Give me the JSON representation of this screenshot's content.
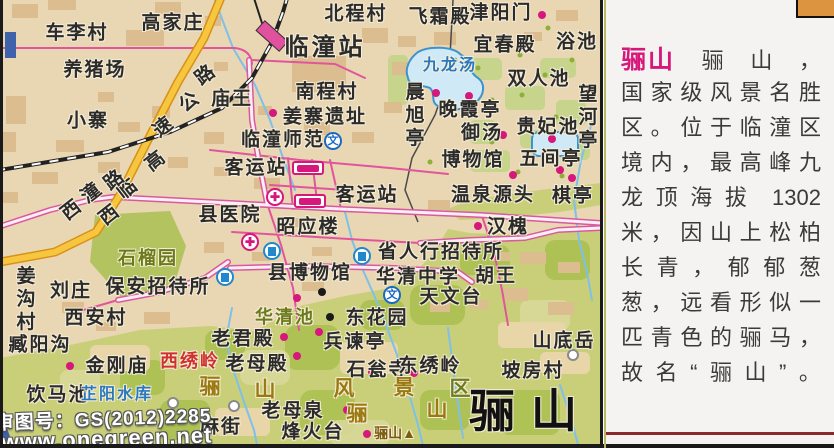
{
  "colors": {
    "accent_magenta": "#d6177b",
    "road_pink": "#e0559c",
    "highway_yellow": "#f6c73e",
    "stream_blue": "#7fc0e8",
    "lake_fill": "#cfe9f7",
    "lake_stroke": "#3d93cc",
    "town_bg": "#e9d6b2",
    "mountain_green": "#c9cf78",
    "panel_bg": "#f4f3f1",
    "orange_tab": "#dd9440",
    "red_label": "#d03030",
    "olive_label": "#6b7a1a"
  },
  "map": {
    "watermark": {
      "line1": "审图号：GS(2012)2285",
      "line2": "www.onegreen.net"
    },
    "labels": [
      {
        "t": "车李村",
        "x": 77,
        "y": 33
      },
      {
        "t": "高家庄",
        "x": 173,
        "y": 23
      },
      {
        "t": "北程村",
        "x": 356,
        "y": 14
      },
      {
        "t": "临潼站",
        "x": 325,
        "y": 48,
        "c": "lg"
      },
      {
        "t": "飞霜殿",
        "x": 440,
        "y": 17
      },
      {
        "t": "津阳门",
        "x": 501,
        "y": 13
      },
      {
        "t": "宜春殿",
        "x": 505,
        "y": 45
      },
      {
        "t": "浴池",
        "x": 577,
        "y": 42
      },
      {
        "t": "养猪场",
        "x": 95,
        "y": 70
      },
      {
        "t": "庙王",
        "x": 232,
        "y": 99
      },
      {
        "t": "南程村",
        "x": 327,
        "y": 92
      },
      {
        "t": "双人池",
        "x": 539,
        "y": 79
      },
      {
        "t": "小寨",
        "x": 88,
        "y": 121
      },
      {
        "t": "姜寨遗址",
        "x": 325,
        "y": 117
      },
      {
        "t": "临潼师范",
        "x": 283,
        "y": 140
      },
      {
        "t": "晚霞亭",
        "x": 470,
        "y": 110
      },
      {
        "t": "贵妃池",
        "x": 548,
        "y": 127
      },
      {
        "t": "御汤",
        "x": 482,
        "y": 133
      },
      {
        "t": "博物馆",
        "x": 473,
        "y": 160
      },
      {
        "t": "五间亭",
        "x": 551,
        "y": 159
      },
      {
        "t": "客运站",
        "x": 256,
        "y": 168
      },
      {
        "t": "客运站",
        "x": 367,
        "y": 195
      },
      {
        "t": "温泉源头",
        "x": 493,
        "y": 195
      },
      {
        "t": "棋亭",
        "x": 573,
        "y": 196
      },
      {
        "t": "县医院",
        "x": 230,
        "y": 215
      },
      {
        "t": "昭应楼",
        "x": 308,
        "y": 227
      },
      {
        "t": "汉槐",
        "x": 508,
        "y": 227
      },
      {
        "t": "省人行招待所",
        "x": 441,
        "y": 252
      },
      {
        "t": "县博物馆",
        "x": 310,
        "y": 273
      },
      {
        "t": "华清中学",
        "x": 418,
        "y": 277
      },
      {
        "t": "胡王",
        "x": 496,
        "y": 276
      },
      {
        "t": "天文台",
        "x": 451,
        "y": 297
      },
      {
        "t": "刘庄",
        "x": 71,
        "y": 291
      },
      {
        "t": "保安招待所",
        "x": 158,
        "y": 287
      },
      {
        "t": "西安村",
        "x": 96,
        "y": 318
      },
      {
        "t": "臧阳沟",
        "x": 40,
        "y": 345
      },
      {
        "t": "金刚庙",
        "x": 117,
        "y": 366
      },
      {
        "t": "饮马池",
        "x": 58,
        "y": 395
      },
      {
        "t": "老君殿",
        "x": 243,
        "y": 339
      },
      {
        "t": "兵谏亭",
        "x": 355,
        "y": 342
      },
      {
        "t": "老母殿",
        "x": 257,
        "y": 364
      },
      {
        "t": "石瓮寺",
        "x": 378,
        "y": 370
      },
      {
        "t": "东绣岭",
        "x": 430,
        "y": 366
      },
      {
        "t": "山底岳",
        "x": 564,
        "y": 341
      },
      {
        "t": "坡房村",
        "x": 533,
        "y": 371
      },
      {
        "t": "东花园",
        "x": 377,
        "y": 318
      },
      {
        "t": "麻街",
        "x": 221,
        "y": 427
      },
      {
        "t": "老母泉",
        "x": 293,
        "y": 411
      },
      {
        "t": "烽火台",
        "x": 313,
        "y": 432
      },
      {
        "t": "九龙汤",
        "x": 450,
        "y": 66,
        "c": "bl"
      },
      {
        "t": "芷阳水库",
        "x": 117,
        "y": 395,
        "c": "bl"
      },
      {
        "t": "石榴园",
        "x": 148,
        "y": 258,
        "c": "ol"
      },
      {
        "t": "华清池",
        "x": 285,
        "y": 317,
        "c": "ol"
      },
      {
        "t": "西绣岭",
        "x": 190,
        "y": 361,
        "c": "rd"
      },
      {
        "t": "骊山",
        "x": 531,
        "y": 411,
        "c": "big"
      },
      {
        "t": "骊",
        "x": 211,
        "y": 387,
        "c": "gold"
      },
      {
        "t": "山",
        "x": 266,
        "y": 390,
        "c": "gold"
      },
      {
        "t": "风",
        "x": 345,
        "y": 389,
        "c": "gold"
      },
      {
        "t": "景",
        "x": 405,
        "y": 388,
        "c": "gold"
      },
      {
        "t": "区",
        "x": 461,
        "y": 389,
        "c": "gold2"
      },
      {
        "t": "骊",
        "x": 358,
        "y": 414,
        "c": "gold"
      },
      {
        "t": "山",
        "x": 438,
        "y": 410,
        "c": "gold"
      },
      {
        "t": "骊山▲",
        "x": 395,
        "y": 433,
        "c": "peak"
      },
      {
        "t": "望河亭",
        "x": 586,
        "y": 118,
        "c": "vert"
      },
      {
        "t": "晨旭亭",
        "x": 413,
        "y": 116,
        "c": "vert"
      },
      {
        "t": "姜沟村",
        "x": 24,
        "y": 300,
        "c": "vert"
      },
      {
        "t": "路",
        "x": 206,
        "y": 75,
        "c": "hwy"
      },
      {
        "t": "公",
        "x": 190,
        "y": 102,
        "c": "hwy"
      },
      {
        "t": "速",
        "x": 164,
        "y": 127,
        "c": "hwy"
      },
      {
        "t": "高",
        "x": 156,
        "y": 161,
        "c": "hwy"
      },
      {
        "t": "临",
        "x": 128,
        "y": 189,
        "c": "hwy"
      },
      {
        "t": "西",
        "x": 110,
        "y": 215,
        "c": "hwy"
      },
      {
        "t": "路",
        "x": 115,
        "y": 180,
        "c": "road"
      },
      {
        "t": "潼",
        "x": 92,
        "y": 193,
        "c": "road"
      },
      {
        "t": "西",
        "x": 72,
        "y": 210,
        "c": "road"
      }
    ],
    "dots": [
      {
        "x": 273,
        "y": 113,
        "c": "m"
      },
      {
        "x": 542,
        "y": 15,
        "c": "m"
      },
      {
        "x": 436,
        "y": 93,
        "c": "m"
      },
      {
        "x": 469,
        "y": 96,
        "c": "m"
      },
      {
        "x": 503,
        "y": 135,
        "c": "m"
      },
      {
        "x": 552,
        "y": 139,
        "c": "m"
      },
      {
        "x": 513,
        "y": 175,
        "c": "m"
      },
      {
        "x": 560,
        "y": 170,
        "c": "m"
      },
      {
        "x": 572,
        "y": 178,
        "c": "m"
      },
      {
        "x": 478,
        "y": 226,
        "c": "m"
      },
      {
        "x": 297,
        "y": 298,
        "c": "m"
      },
      {
        "x": 284,
        "y": 337,
        "c": "m"
      },
      {
        "x": 319,
        "y": 332,
        "c": "m"
      },
      {
        "x": 297,
        "y": 356,
        "c": "m"
      },
      {
        "x": 372,
        "y": 372,
        "c": "m"
      },
      {
        "x": 414,
        "y": 373,
        "c": "m"
      },
      {
        "x": 347,
        "y": 410,
        "c": "m"
      },
      {
        "x": 367,
        "y": 434,
        "c": "m"
      },
      {
        "x": 70,
        "y": 366,
        "c": "m"
      },
      {
        "x": 322,
        "y": 292,
        "c": "k"
      },
      {
        "x": 330,
        "y": 317,
        "c": "k"
      },
      {
        "x": 173,
        "y": 403,
        "c": "w"
      },
      {
        "x": 234,
        "y": 406,
        "c": "w"
      },
      {
        "x": 573,
        "y": 355,
        "c": "w"
      }
    ],
    "icons": [
      {
        "type": "school",
        "x": 333,
        "y": 141
      },
      {
        "type": "school",
        "x": 392,
        "y": 295
      },
      {
        "type": "hospital",
        "x": 275,
        "y": 197
      },
      {
        "type": "hospital",
        "x": 250,
        "y": 242
      },
      {
        "type": "hotel",
        "x": 272,
        "y": 251
      },
      {
        "type": "hotel",
        "x": 362,
        "y": 256
      },
      {
        "type": "hotel",
        "x": 225,
        "y": 277
      },
      {
        "type": "bus",
        "x": 308,
        "y": 168
      },
      {
        "type": "bus",
        "x": 310,
        "y": 201
      }
    ],
    "icon_glyphs": {
      "school": "文",
      "hospital": "✚"
    }
  },
  "panel": {
    "title": "骊山",
    "first_line_rest": "骊山，",
    "lines": [
      "国家级风景名胜",
      "区。位于临潼区",
      "境内，最高峰九",
      "龙顶海拔 1302",
      "米，因山上松柏",
      "长青，郁郁葱",
      "葱，远看形似一",
      "匹青色的骊马，",
      "故名“骊山”。"
    ]
  }
}
